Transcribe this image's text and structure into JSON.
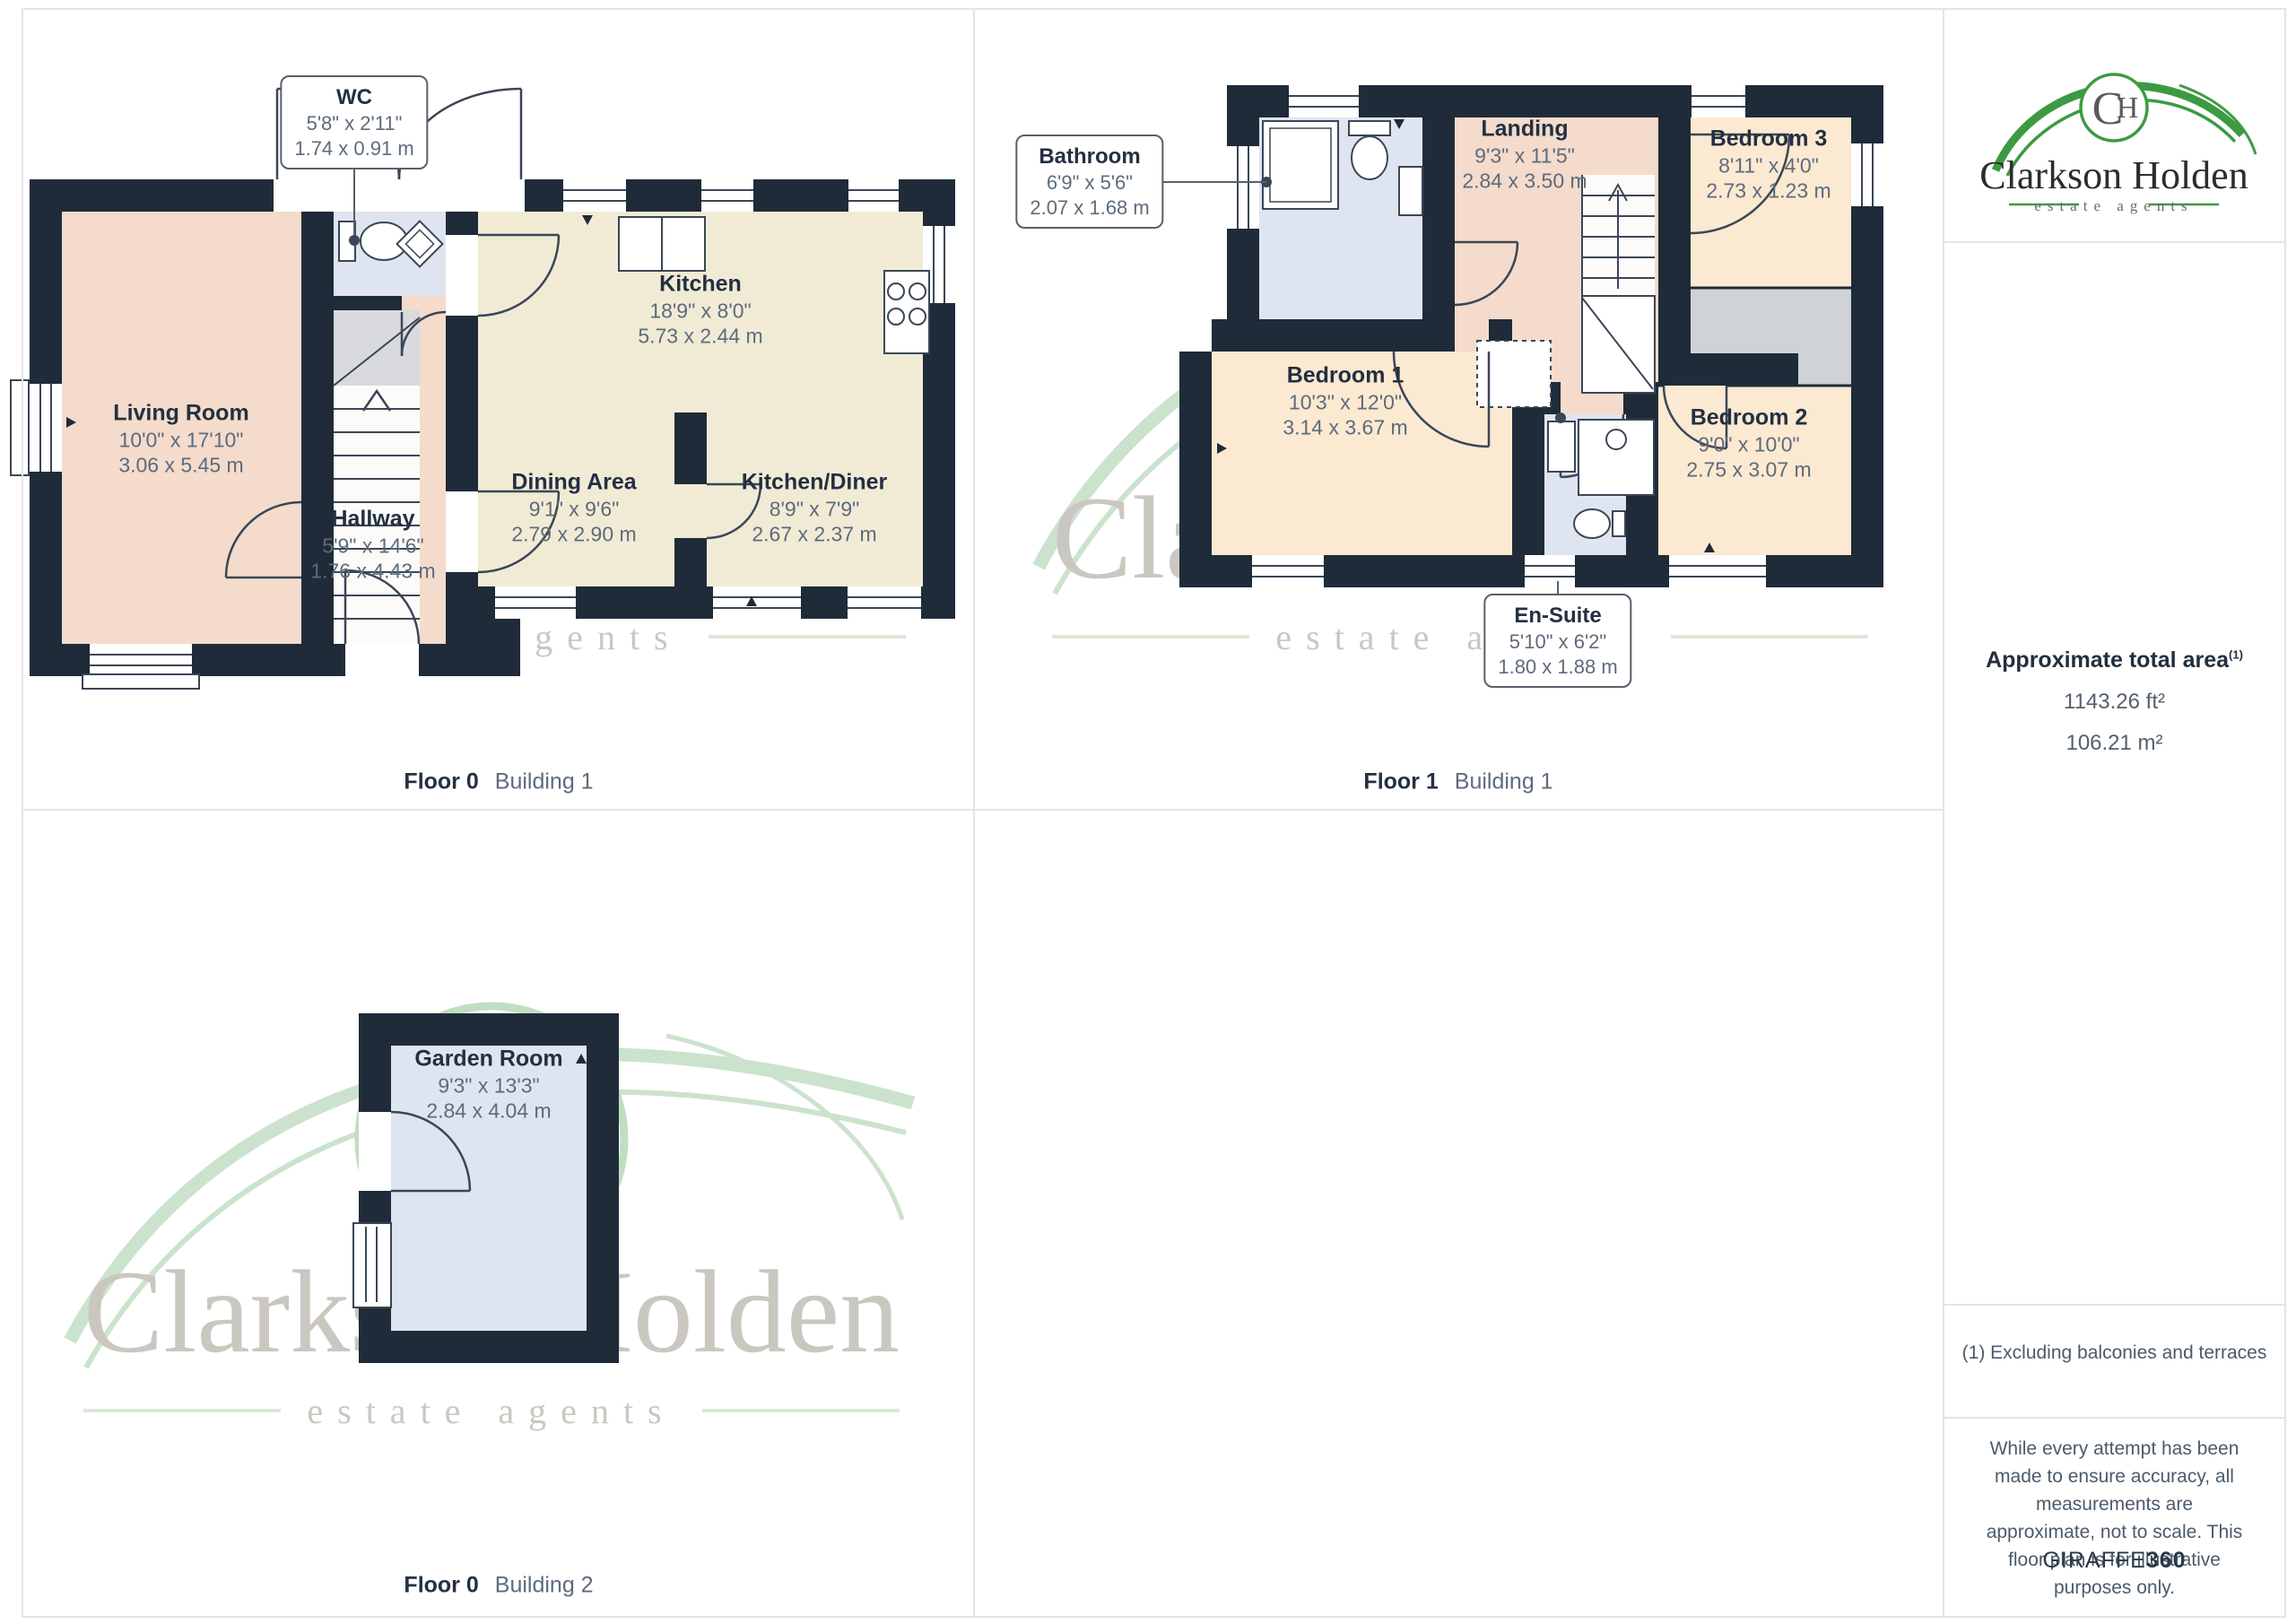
{
  "brand": {
    "logo_title": "Clarkson Holden",
    "logo_subtitle": "estate agents",
    "monogram_c": "C",
    "monogram_h": "H"
  },
  "plans": [
    {
      "caption_floor": "Floor 0",
      "caption_building": "Building 1",
      "rooms": [
        {
          "name": "Living Room",
          "imperial": "10'0\" x 17'10\"",
          "metric": "3.06 x 5.45 m"
        },
        {
          "name": "Hallway",
          "imperial": "5'9\" x 14'6\"",
          "metric": "1.76 x 4.43 m"
        },
        {
          "name": "Kitchen",
          "imperial": "18'9\" x 8'0\"",
          "metric": "5.73 x 2.44 m"
        },
        {
          "name": "Dining Area",
          "imperial": "9'1\" x 9'6\"",
          "metric": "2.79 x 2.90 m"
        },
        {
          "name": "Kitchen/Diner",
          "imperial": "8'9\" x 7'9\"",
          "metric": "2.67 x 2.37 m"
        }
      ],
      "callouts": [
        {
          "name": "WC",
          "imperial": "5'8\" x 2'11\"",
          "metric": "1.74 x 0.91 m"
        }
      ]
    },
    {
      "caption_floor": "Floor 1",
      "caption_building": "Building 1",
      "rooms": [
        {
          "name": "Landing",
          "imperial": "9'3\" x 11'5\"",
          "metric": "2.84 x 3.50 m"
        },
        {
          "name": "Bedroom 3",
          "imperial": "8'11\" x 4'0\"",
          "metric": "2.73 x 1.23 m"
        },
        {
          "name": "Bedroom 1",
          "imperial": "10'3\" x 12'0\"",
          "metric": "3.14 x 3.67 m"
        },
        {
          "name": "Bedroom 2",
          "imperial": "9'0\" x 10'0\"",
          "metric": "2.75 x 3.07 m"
        }
      ],
      "callouts": [
        {
          "name": "Bathroom",
          "imperial": "6'9\" x 5'6\"",
          "metric": "2.07 x 1.68 m"
        },
        {
          "name": "En-Suite",
          "imperial": "5'10\" x 6'2\"",
          "metric": "1.80 x 1.88 m"
        }
      ]
    },
    {
      "caption_floor": "Floor 0",
      "caption_building": "Building 2",
      "rooms": [
        {
          "name": "Garden Room",
          "imperial": "9'3\" x 13'3\"",
          "metric": "2.84 x 4.04 m"
        }
      ],
      "callouts": []
    }
  ],
  "sidebar": {
    "area_title": "Approximate total area",
    "area_marker": "(1)",
    "area_ft": "1143.26 ft²",
    "area_m": "106.21 m²",
    "footnote": "(1) Excluding balconies and terraces",
    "disclaimer": "While every attempt has been made to ensure accuracy, all measurements are approximate, not to scale. This floor plan is for illustrative purposes only.",
    "brand_name": "GIRAFFE",
    "brand_suffix": "360"
  },
  "colors": {
    "wall": "#1f2b39",
    "room_peach": "#f4dbcc",
    "room_cream": "#fbe9d2",
    "room_beige": "#f1ebd6",
    "room_wet": "#dfe5f0",
    "accent_green": "#3d9a43"
  }
}
